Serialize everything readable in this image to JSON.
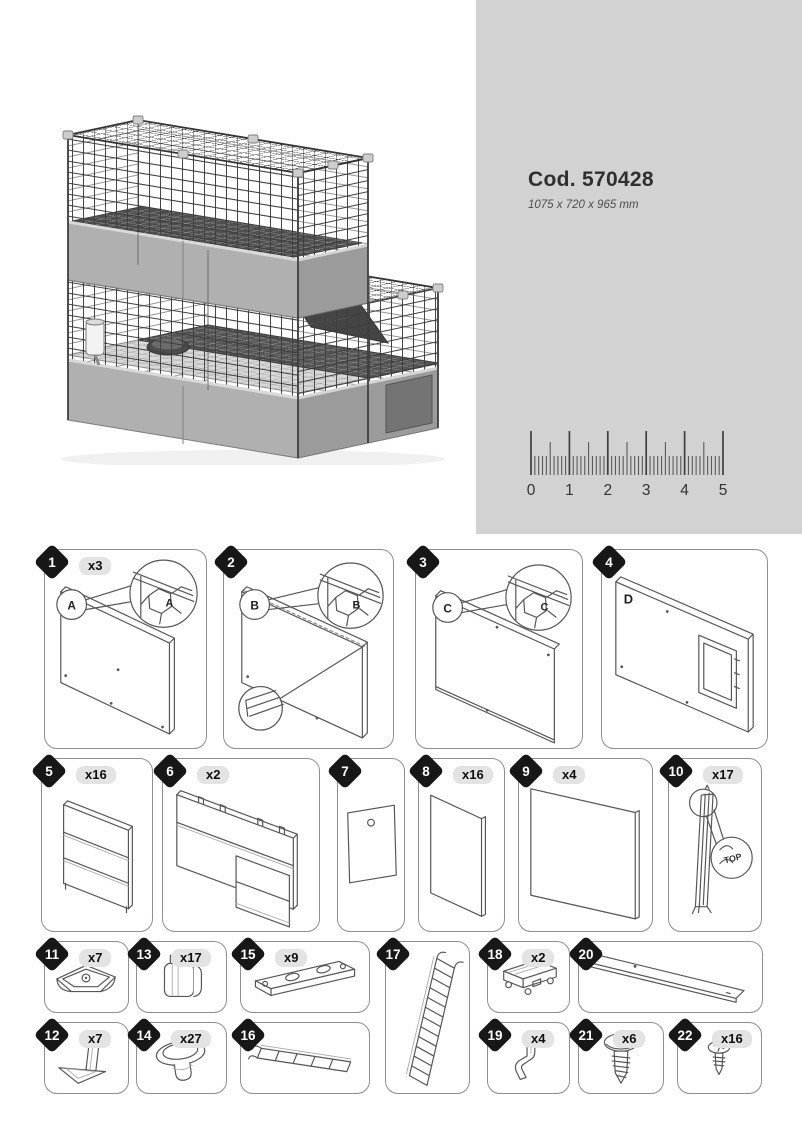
{
  "header": {
    "code": "Cod. 570428",
    "dimensions": "1075 x 720 x 965 mm"
  },
  "ruler": {
    "labels": [
      "0",
      "1",
      "2",
      "3",
      "4",
      "5"
    ]
  },
  "parts": [
    {
      "num": "1",
      "qty": "x3",
      "letter": "A"
    },
    {
      "num": "2",
      "qty": "",
      "letter": "B"
    },
    {
      "num": "3",
      "qty": "",
      "letter": "C"
    },
    {
      "num": "4",
      "qty": "",
      "letter": "D"
    },
    {
      "num": "5",
      "qty": "x16"
    },
    {
      "num": "6",
      "qty": "x2"
    },
    {
      "num": "7",
      "qty": ""
    },
    {
      "num": "8",
      "qty": "x16"
    },
    {
      "num": "9",
      "qty": "x4"
    },
    {
      "num": "10",
      "qty": "x17",
      "detail_label": "TOP"
    },
    {
      "num": "11",
      "qty": "x7"
    },
    {
      "num": "12",
      "qty": "x7"
    },
    {
      "num": "13",
      "qty": "x17"
    },
    {
      "num": "14",
      "qty": "x27"
    },
    {
      "num": "15",
      "qty": "x9"
    },
    {
      "num": "16",
      "qty": ""
    },
    {
      "num": "17",
      "qty": ""
    },
    {
      "num": "18",
      "qty": "x2"
    },
    {
      "num": "19",
      "qty": "x4"
    },
    {
      "num": "20",
      "qty": ""
    },
    {
      "num": "21",
      "qty": "x6"
    },
    {
      "num": "22",
      "qty": "x16"
    }
  ]
}
